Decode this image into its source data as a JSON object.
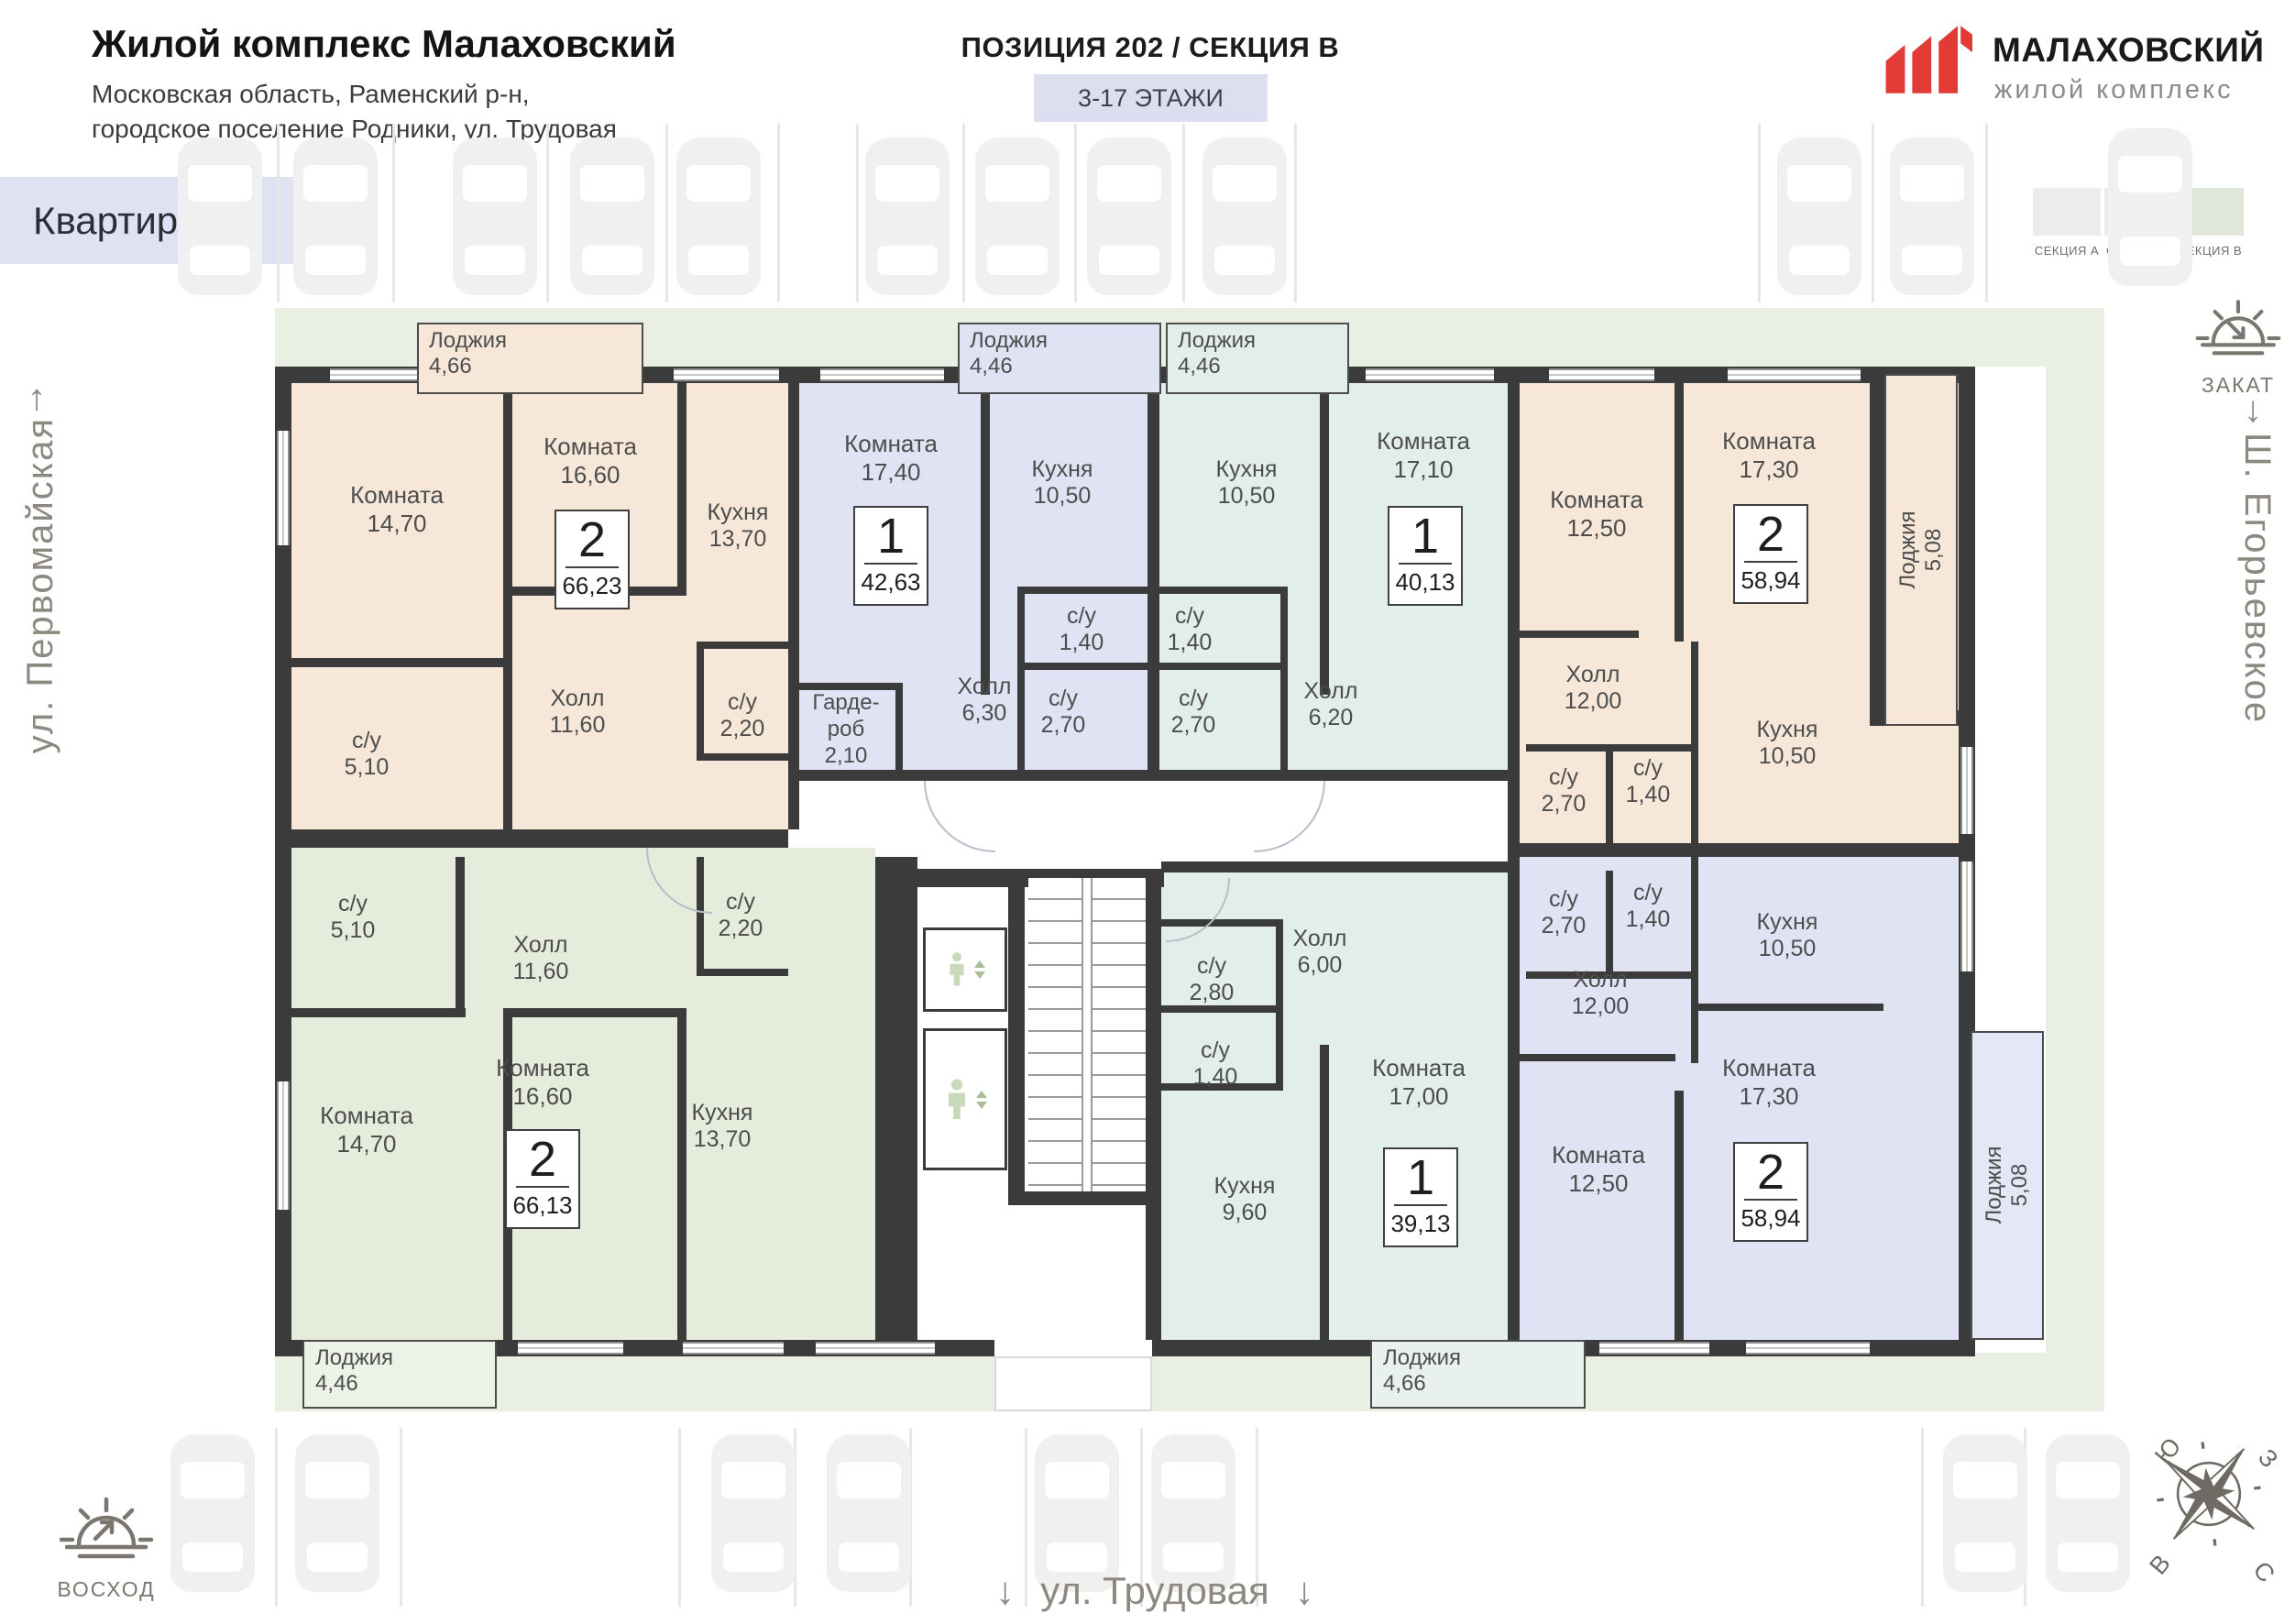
{
  "header": {
    "title": "Жилой комплекс Малаховский",
    "address_line1": "Московская область, Раменский р-н,",
    "address_line2": "городское поселение Родники, ул. Трудовая",
    "position_title": "ПОЗИЦИЯ 202 / СЕКЦИЯ В",
    "floors_badge": "3-17 ЭТАЖИ",
    "page_tab": "Квартиры"
  },
  "logo": {
    "brand": "МАЛАХОВСКИЙ",
    "subtitle": "жилой комплекс",
    "accent_color": "#e23a34"
  },
  "legend": {
    "items": [
      {
        "label": "СЕКЦИЯ А",
        "color": "#ececec"
      },
      {
        "label": "СЕКЦИЯ Б",
        "color": "#ececec"
      },
      {
        "label": "СЕКЦИЯ В",
        "color": "#dfe8d8"
      }
    ]
  },
  "environment": {
    "street_left": "ул. Первомайская",
    "street_right": "Ш. Егорьевское",
    "street_bottom": "ул. Трудовая",
    "sunset_label": "ЗАКАТ",
    "sunrise_label": "ВОСХОД",
    "arrow_up": "↑",
    "arrow_down": "↓",
    "compass": {
      "n": "С",
      "s": "Ю",
      "w": "З",
      "e": "В"
    }
  },
  "palette": {
    "wall": "#3b3b3b",
    "lawn": "#e9efe3",
    "tab_bg": "#dfe2f2",
    "badge_bg": "#dbdff0",
    "car": "#f0f0f0"
  },
  "apartments": [
    {
      "type": "2",
      "area": "66,23",
      "color": "#f6e7d9",
      "loggia": {
        "label": "Лоджия",
        "area": "4,66",
        "color": "#f6e7d9"
      },
      "rooms": [
        {
          "label": "Комната",
          "area": "14,70"
        },
        {
          "label": "Комната",
          "area": "16,60"
        },
        {
          "label": "Кухня",
          "area": "13,70"
        },
        {
          "label": "Холл",
          "area": "11,60"
        },
        {
          "label": "с/у",
          "area": "5,10"
        },
        {
          "label": "с/у",
          "area": "2,20"
        }
      ]
    },
    {
      "type": "1",
      "area": "42,63",
      "color": "#dfe3f4",
      "loggia": {
        "label": "Лоджия",
        "area": "4,46",
        "color": "#dfe3f4"
      },
      "rooms": [
        {
          "label": "Комната",
          "area": "17,40"
        },
        {
          "label": "Кухня",
          "area": "10,50"
        },
        {
          "label": "Гарде-роб",
          "area": "2,10"
        },
        {
          "label": "Холл",
          "area": "6,30"
        },
        {
          "label": "с/у",
          "area": "1,40"
        },
        {
          "label": "с/у",
          "area": "2,70"
        }
      ]
    },
    {
      "type": "1",
      "area": "40,13",
      "color": "#e2eeea",
      "loggia": {
        "label": "Лоджия",
        "area": "4,46",
        "color": "#e2eeea"
      },
      "rooms": [
        {
          "label": "Кухня",
          "area": "10,50"
        },
        {
          "label": "Комната",
          "area": "17,10"
        },
        {
          "label": "с/у",
          "area": "1,40"
        },
        {
          "label": "с/у",
          "area": "2,70"
        },
        {
          "label": "Холл",
          "area": "6,20"
        }
      ]
    },
    {
      "type": "2",
      "area": "58,94",
      "color": "#f6e7d9",
      "loggia": {
        "label": "Лоджия",
        "area": "5,08",
        "color": "#f6e7d9"
      },
      "rooms": [
        {
          "label": "Комната",
          "area": "12,50"
        },
        {
          "label": "Комната",
          "area": "17,30"
        },
        {
          "label": "Холл",
          "area": "12,00"
        },
        {
          "label": "Кухня",
          "area": "10,50"
        },
        {
          "label": "с/у",
          "area": "2,70"
        },
        {
          "label": "с/у",
          "area": "1,40"
        }
      ]
    },
    {
      "type": "2",
      "area": "66,13",
      "color": "#e5ecdc",
      "loggia": {
        "label": "Лоджия",
        "area": "4,46",
        "color": "#edf2e6"
      },
      "rooms": [
        {
          "label": "с/у",
          "area": "5,10"
        },
        {
          "label": "Холл",
          "area": "11,60"
        },
        {
          "label": "Комната",
          "area": "14,70"
        },
        {
          "label": "Комната",
          "area": "16,60"
        },
        {
          "label": "Кухня",
          "area": "13,70"
        },
        {
          "label": "с/у",
          "area": "2,20"
        }
      ]
    },
    {
      "type": "1",
      "area": "39,13",
      "color": "#e2eeea",
      "loggia": {
        "label": "Лоджия",
        "area": "4,66",
        "color": "#e8f1ed"
      },
      "rooms": [
        {
          "label": "с/у",
          "area": "2,80"
        },
        {
          "label": "с/у",
          "area": "1,40"
        },
        {
          "label": "Холл",
          "area": "6,00"
        },
        {
          "label": "Кухня",
          "area": "9,60"
        },
        {
          "label": "Комната",
          "area": "17,00"
        }
      ]
    },
    {
      "type": "2",
      "area": "58,94",
      "color": "#dfe3f4",
      "loggia": {
        "label": "Лоджия",
        "area": "5,08",
        "color": "#e3e7f6"
      },
      "rooms": [
        {
          "label": "с/у",
          "area": "2,70"
        },
        {
          "label": "с/у",
          "area": "1,40"
        },
        {
          "label": "Кухня",
          "area": "10,50"
        },
        {
          "label": "Холл",
          "area": "12,00"
        },
        {
          "label": "Комната",
          "area": "12,50"
        },
        {
          "label": "Комната",
          "area": "17,30"
        }
      ]
    }
  ]
}
